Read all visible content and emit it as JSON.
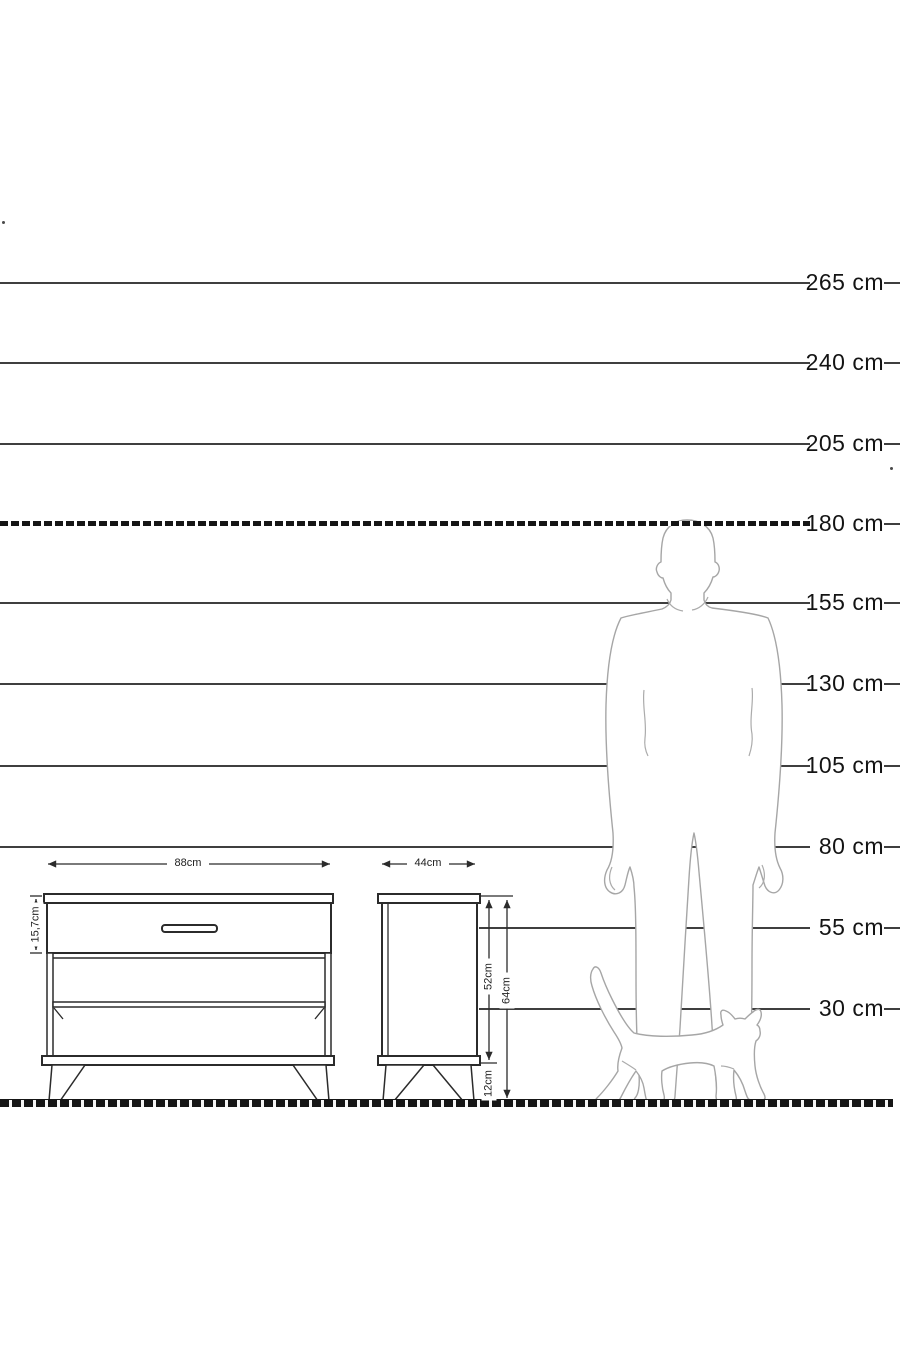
{
  "scale": {
    "labels": [
      "265 cm",
      "240 cm",
      "205 cm",
      "180 cm",
      "155 cm",
      "130 cm",
      "105 cm",
      "80 cm",
      "55 cm",
      "30 cm"
    ]
  },
  "dimensions": {
    "front_width": "88cm",
    "drawer_height": "15,7cm",
    "side_depth": "44cm",
    "body_height": "52cm",
    "total_height": "64cm",
    "leg_height": "12cm"
  },
  "figures": {
    "man": "standing-man-silhouette",
    "cat": "walking-cat-silhouette"
  },
  "colors": {
    "background": "#ffffff",
    "grid_line": "#3f3f3f",
    "dashed_line": "#151515",
    "furniture_line": "#2b2b2b",
    "figure_line": "#a6a6a6",
    "label_text": "#141414",
    "dimension_text": "#222222"
  }
}
